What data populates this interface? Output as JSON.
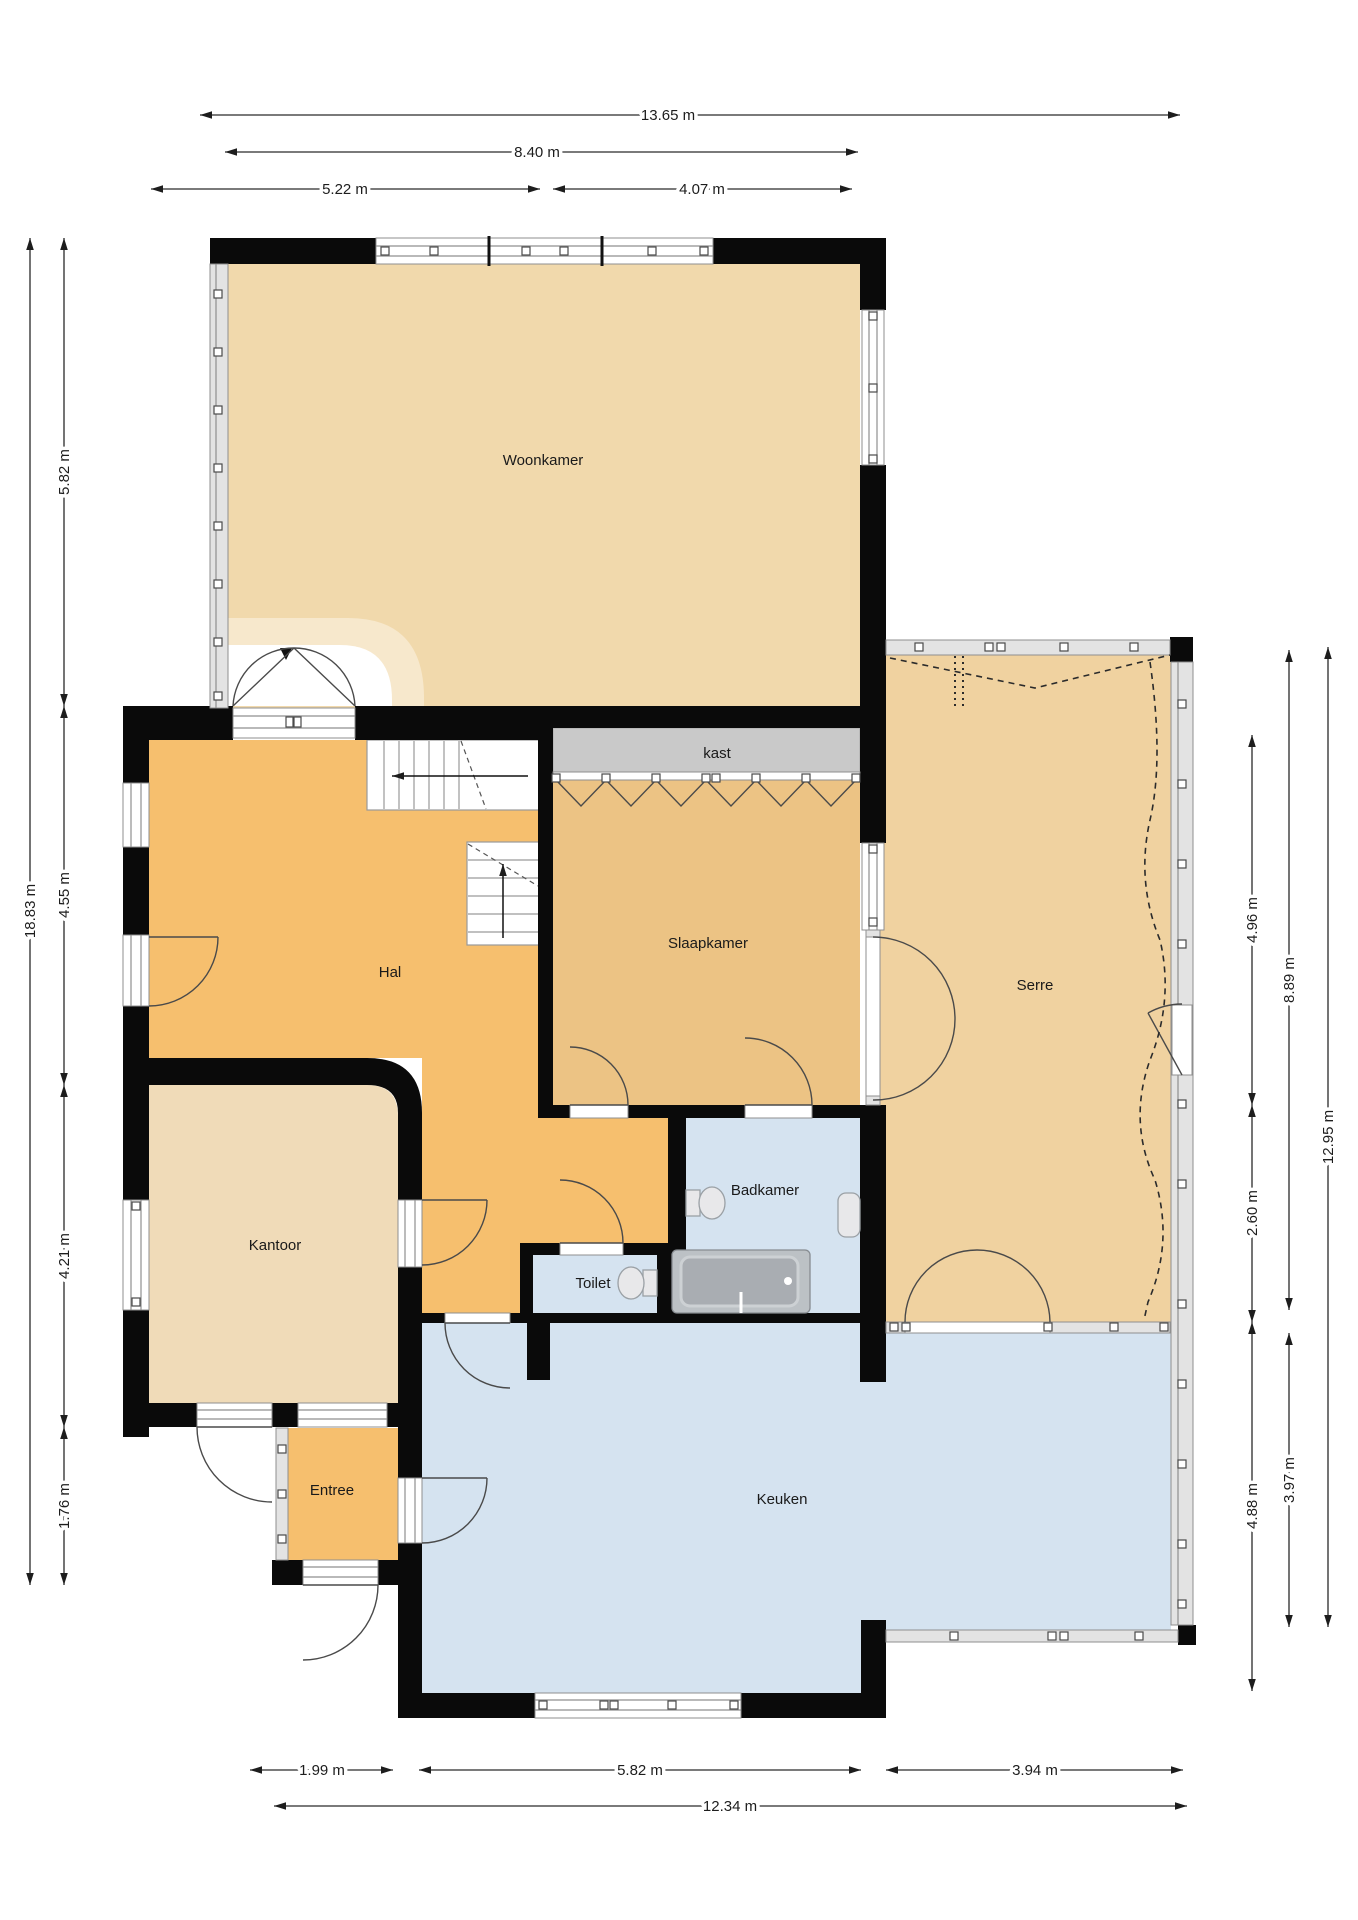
{
  "plan_title": "Begane grond plattegrond",
  "rooms": {
    "woonkamer": "Woonkamer",
    "hal": "Hal",
    "slaapkamer": "Slaapkamer",
    "serre": "Serre",
    "kantoor": "Kantoor",
    "toilet": "Toilet",
    "badkamer": "Badkamer",
    "entree": "Entree",
    "keuken": "Keuken",
    "kast": "kast"
  },
  "colors": {
    "wall": "#0a0a0a",
    "woonkamer": "#F1D9AC",
    "kantoor": "#F0DBB8",
    "serre": "#F0D2A0",
    "slaapkamer": "#ECC384",
    "hal_entree": "#F6BF6E",
    "keuken_bad_toilet": "#D5E3F0",
    "kast": "#C9C9C9",
    "glazing": "#E3E3E3",
    "dimension_text": "#1d1d1d"
  },
  "dimensions": [
    {
      "label": "13.65 m",
      "x1": 200,
      "y1": 115,
      "x2": 1180,
      "y2": 115,
      "lx": 668,
      "ly": 120,
      "rot": false
    },
    {
      "label": "8.40 m",
      "x1": 225,
      "y1": 152,
      "x2": 858,
      "y2": 152,
      "lx": 537,
      "ly": 157,
      "rot": false
    },
    {
      "label": "5.22 m",
      "x1": 151,
      "y1": 189,
      "x2": 540,
      "y2": 189,
      "lx": 345,
      "ly": 194,
      "rot": false
    },
    {
      "label": "4.07 m",
      "x1": 553,
      "y1": 189,
      "x2": 852,
      "y2": 189,
      "lx": 702,
      "ly": 194,
      "rot": false
    },
    {
      "label": "18.83 m",
      "x1": 30,
      "y1": 238,
      "x2": 30,
      "y2": 1585,
      "lx": 35,
      "ly": 911,
      "rot": true
    },
    {
      "label": "5.82 m",
      "x1": 64,
      "y1": 238,
      "x2": 64,
      "y2": 706,
      "lx": 69,
      "ly": 472,
      "rot": true
    },
    {
      "label": "4.55 m",
      "x1": 64,
      "y1": 706,
      "x2": 64,
      "y2": 1085,
      "lx": 69,
      "ly": 895,
      "rot": true
    },
    {
      "label": "4.21 m",
      "x1": 64,
      "y1": 1085,
      "x2": 64,
      "y2": 1427,
      "lx": 69,
      "ly": 1256,
      "rot": true
    },
    {
      "label": "1.76 m",
      "x1": 64,
      "y1": 1427,
      "x2": 64,
      "y2": 1585,
      "lx": 69,
      "ly": 1506,
      "rot": true
    },
    {
      "label": "4.96 m",
      "x1": 1252,
      "y1": 735,
      "x2": 1252,
      "y2": 1105,
      "lx": 1257,
      "ly": 920,
      "rot": true
    },
    {
      "label": "2.60 m",
      "x1": 1252,
      "y1": 1105,
      "x2": 1252,
      "y2": 1322,
      "lx": 1257,
      "ly": 1213,
      "rot": true
    },
    {
      "label": "4.88 m",
      "x1": 1252,
      "y1": 1322,
      "x2": 1252,
      "y2": 1691,
      "lx": 1257,
      "ly": 1506,
      "rot": true
    },
    {
      "label": "8.89 m",
      "x1": 1289,
      "y1": 650,
      "x2": 1289,
      "y2": 1310,
      "lx": 1294,
      "ly": 980,
      "rot": true
    },
    {
      "label": "3.97 m",
      "x1": 1289,
      "y1": 1333,
      "x2": 1289,
      "y2": 1627,
      "lx": 1294,
      "ly": 1480,
      "rot": true
    },
    {
      "label": "12.95 m",
      "x1": 1328,
      "y1": 647,
      "x2": 1328,
      "y2": 1627,
      "lx": 1333,
      "ly": 1137,
      "rot": true
    },
    {
      "label": "1.99 m",
      "x1": 250,
      "y1": 1770,
      "x2": 393,
      "y2": 1770,
      "lx": 322,
      "ly": 1775,
      "rot": false
    },
    {
      "label": "5.82 m",
      "x1": 419,
      "y1": 1770,
      "x2": 861,
      "y2": 1770,
      "lx": 640,
      "ly": 1775,
      "rot": false
    },
    {
      "label": "3.94 m",
      "x1": 886,
      "y1": 1770,
      "x2": 1183,
      "y2": 1770,
      "lx": 1035,
      "ly": 1775,
      "rot": false
    },
    {
      "label": "12.34 m",
      "x1": 274,
      "y1": 1806,
      "x2": 1187,
      "y2": 1806,
      "lx": 730,
      "ly": 1811,
      "rot": false
    }
  ]
}
